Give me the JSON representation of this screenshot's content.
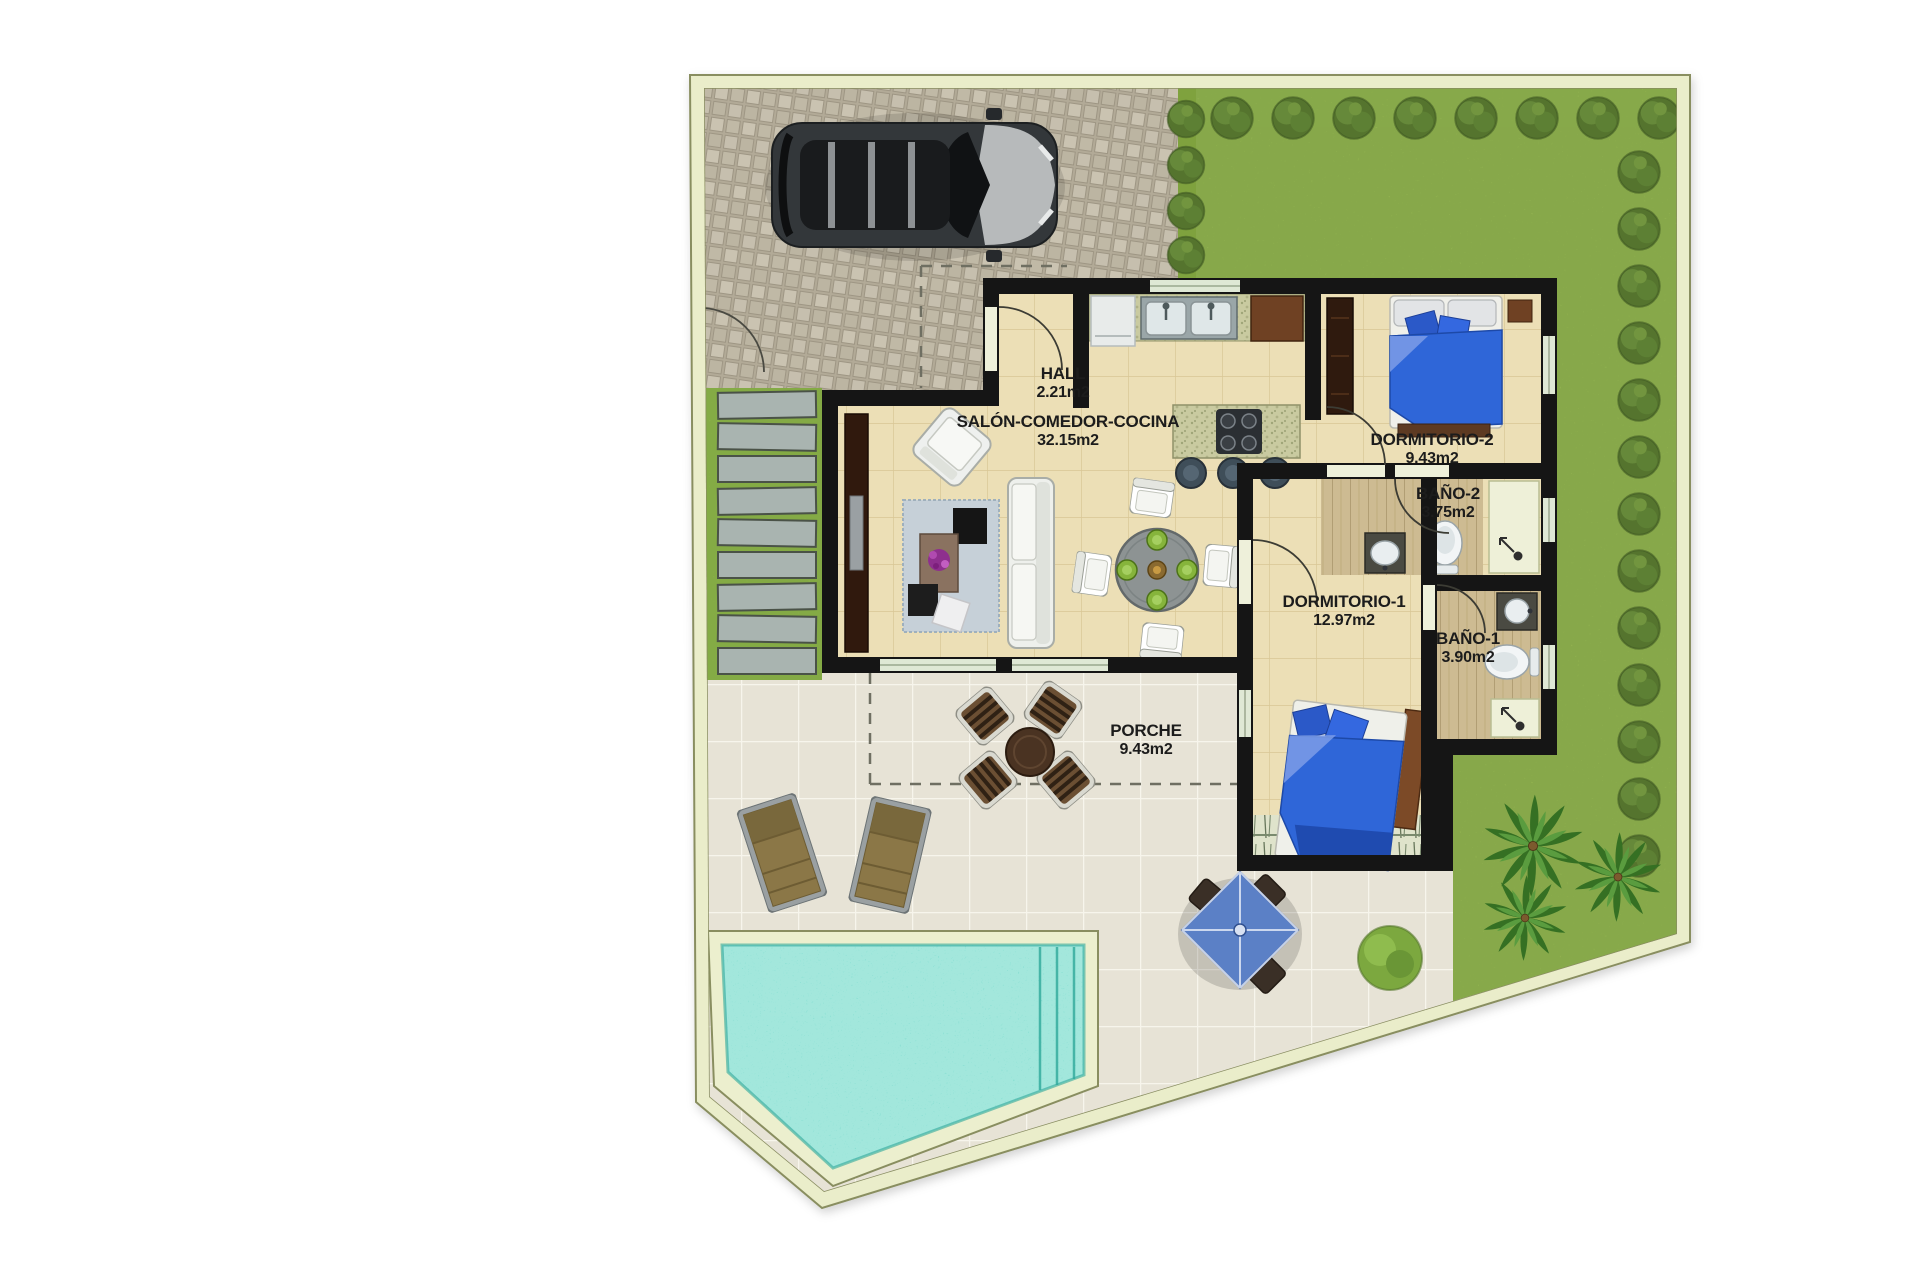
{
  "plan": {
    "type": "villa-floor-plan",
    "rooms": [
      {
        "id": "hall",
        "name": "HALL",
        "area": "2.21m2"
      },
      {
        "id": "salon",
        "name": "SALÓN-COMEDOR-COCINA",
        "area": "32.15m2"
      },
      {
        "id": "dormitorio2",
        "name": "DORMITORIO-2",
        "area": "9.43m2"
      },
      {
        "id": "bano2",
        "name": "BAÑO-2",
        "area": "3.75m2"
      },
      {
        "id": "dormitorio1",
        "name": "DORMITORIO-1",
        "area": "12.97m2"
      },
      {
        "id": "bano1",
        "name": "BAÑO-1",
        "area": "3.90m2"
      },
      {
        "id": "porche",
        "name": "PORCHE",
        "area": "9.43m2"
      }
    ],
    "colors": {
      "wall": "#151515",
      "plot_border": "#eaedca",
      "border_line": "#898e60",
      "grass": "#a6c359",
      "grass_strip": "#9cc14f",
      "driveway": "#b4ac99",
      "patio": "#e7e3d6",
      "house_floor": "#ecdfb6",
      "bath_floor": "#cdbb92",
      "pool_water": "#57cfbf",
      "pool_deck": "#ecefce",
      "bed_blue": "#2f66d8",
      "paver": "#a9b4b0",
      "gazebo_blue": "#5b80c6",
      "label_text": "#1c1c1c"
    }
  }
}
